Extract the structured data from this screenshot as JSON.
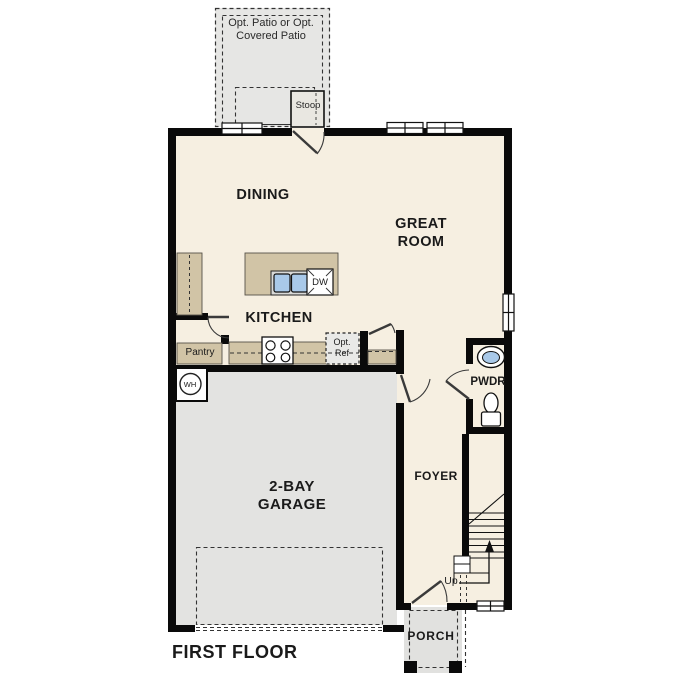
{
  "page": {
    "title": "FIRST FLOOR"
  },
  "colors": {
    "floor": "#f6efe1",
    "cabinet": "#d1c4a6",
    "garage": "#e3e3e1",
    "patio": "#e6e6e4",
    "wall": "#0a0a0a",
    "sink_blue": "#a9c9e9"
  },
  "rooms": {
    "patio": {
      "label": "Opt. Patio or Opt. Covered Patio"
    },
    "stoop": {
      "label": "Stoop"
    },
    "dining": {
      "label": "DINING"
    },
    "great_room": {
      "label": "GREAT ROOM"
    },
    "kitchen": {
      "label": "KITCHEN"
    },
    "pantry": {
      "label": "Pantry"
    },
    "powder_room": {
      "label": "PWDR"
    },
    "foyer": {
      "label": "FOYER"
    },
    "garage": {
      "label": "2-BAY GARAGE"
    },
    "porch": {
      "label": "PORCH"
    }
  },
  "features": {
    "dishwasher": {
      "label": "DW"
    },
    "water_heater": {
      "label": "WH"
    },
    "optional_refrigerator": {
      "label": "Opt. Ref"
    },
    "stairs_direction": {
      "label": "Up"
    }
  },
  "footer": {
    "floor_title": "FIRST FLOOR"
  }
}
